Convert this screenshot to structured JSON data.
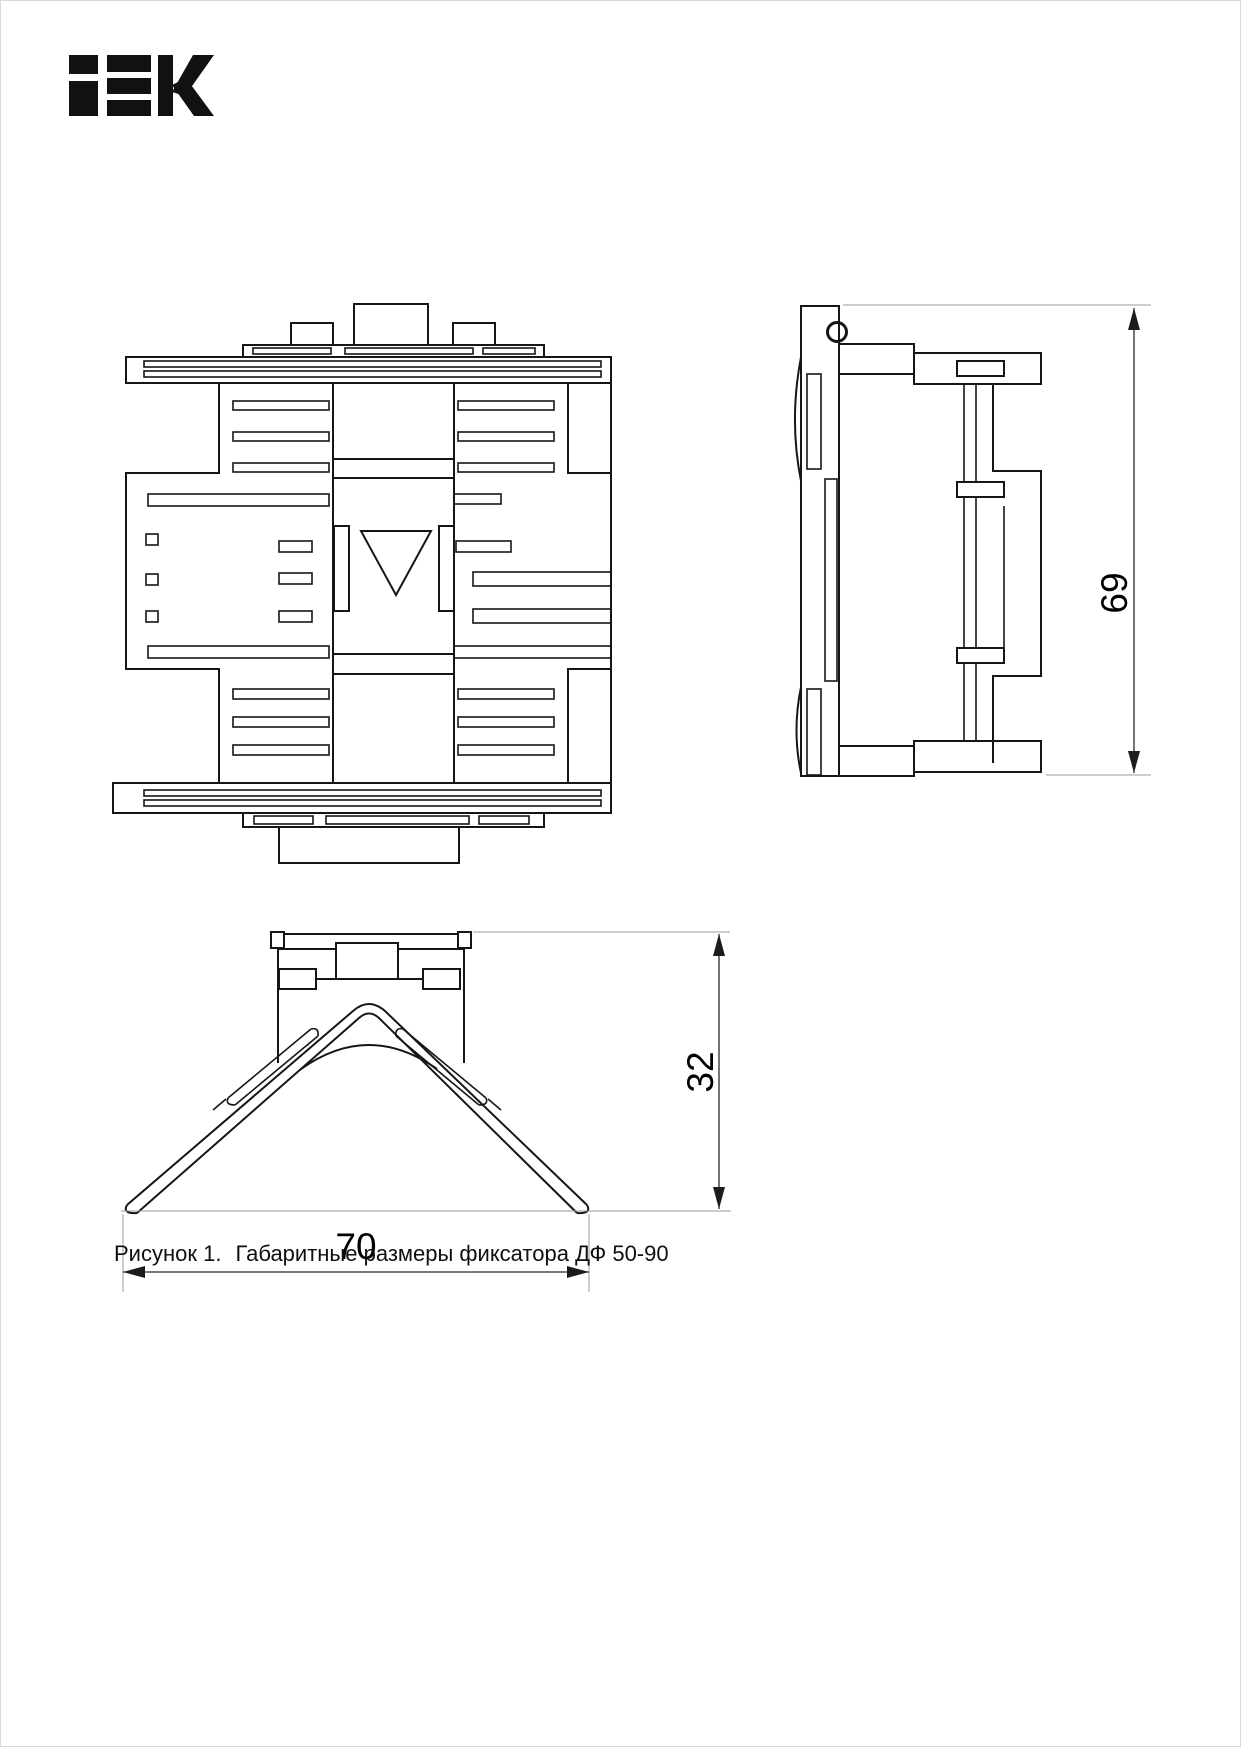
{
  "page": {
    "background": "#ffffff",
    "border_color": "#d9d9d9",
    "line_color": "#161616"
  },
  "logo": {
    "text": "IEK",
    "color": "#111111"
  },
  "caption": {
    "label": "Рисунок 1.",
    "text": "Габаритные размеры фиксатора ДФ 50-90"
  },
  "views": {
    "front_view": "фиксатор — вид спереди",
    "side_view": "фиксатор — вид сбоку",
    "profile_view": "фиксатор — вид снизу (профиль)"
  },
  "dimensions": {
    "side_height": {
      "value": "69",
      "orientation": "vertical"
    },
    "profile_height": {
      "value": "32",
      "orientation": "vertical"
    },
    "profile_width": {
      "value": "70",
      "orientation": "horizontal"
    }
  }
}
